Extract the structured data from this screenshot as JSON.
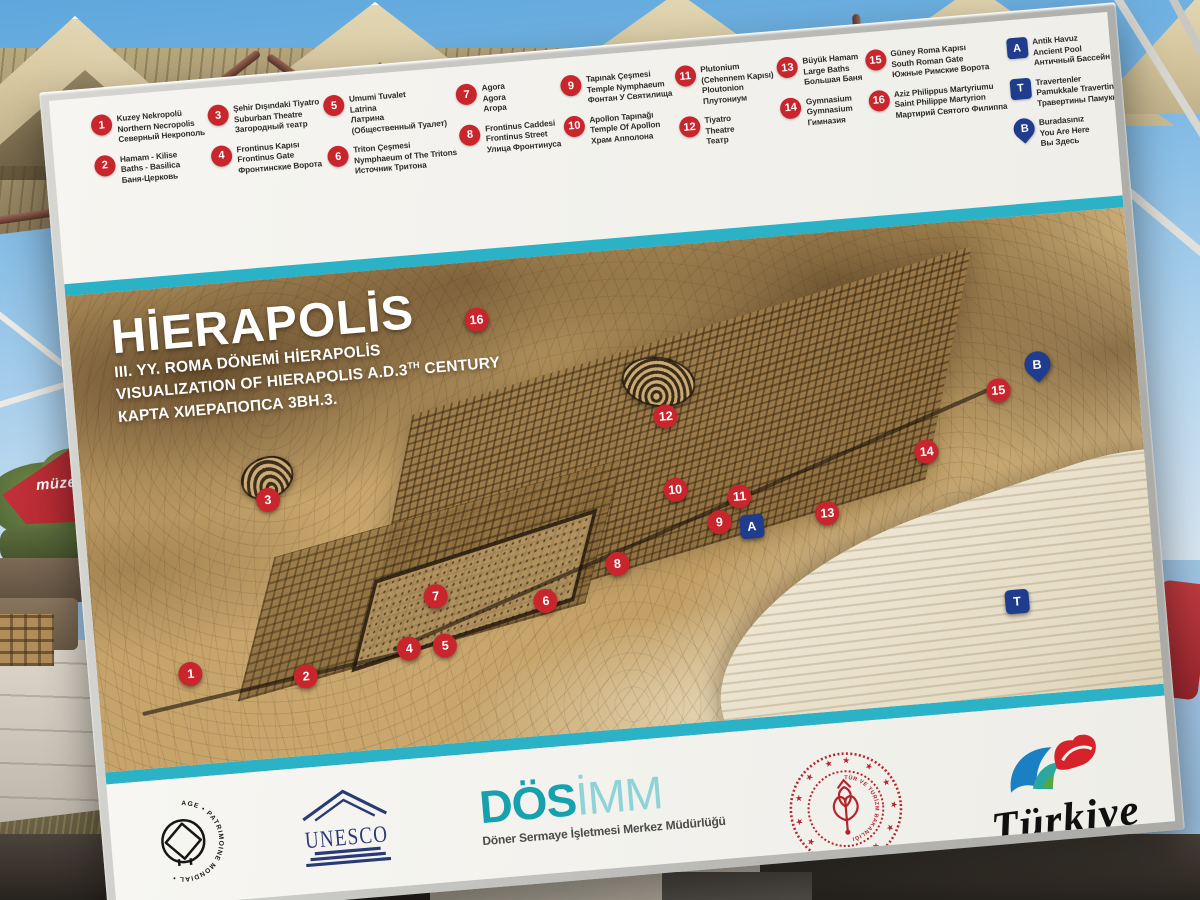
{
  "board": {
    "title": "HİERAPOLİS",
    "subtitle_tr": "III. YY. ROMA DÖNEMİ HİERAPOLİS",
    "subtitle_en_pre": "VISUALIZATION OF HIERAPOLIS A.D.3",
    "subtitle_en_sup": "TH",
    "subtitle_en_post": " CENTURY",
    "subtitle_ru": "КАРТА ХИЕРАПОПСА 3ВН.3.",
    "colors": {
      "marker_red": "#c8252c",
      "marker_blue": "#1f3d8c",
      "stripe_teal": "#2bb2c6",
      "unesco_navy": "#2a3a74",
      "ministry_red": "#b5232d",
      "dosimm_teal": "#17a0ae",
      "dosimm_light_teal": "#8fd2d8",
      "legend_text": "#2e2d2b"
    },
    "legend": {
      "columns": [
        {
          "items": [
            {
              "id": "1",
              "shape": "circle",
              "lines": [
                "Kuzey Nekropolü",
                "Northern Necropolis",
                "Северный Некрополь"
              ]
            },
            {
              "id": "2",
              "shape": "circle",
              "lines": [
                "Hamam - Kilise",
                "Baths - Basilica",
                "Баня-Церковь"
              ]
            }
          ]
        },
        {
          "items": [
            {
              "id": "3",
              "shape": "circle",
              "lines": [
                "Şehir Dışındaki Tiyatro",
                "Suburban Theatre",
                "Загородный театр"
              ]
            },
            {
              "id": "4",
              "shape": "circle",
              "lines": [
                "Frontinus Kapısı",
                "Frontinus Gate",
                "Фронтинские Ворота"
              ]
            }
          ]
        },
        {
          "items": [
            {
              "id": "5",
              "shape": "circle",
              "lines": [
                "Umumi Tuvalet",
                "Latrina",
                "Латрина",
                "(Общественный Туалет)"
              ]
            },
            {
              "id": "6",
              "shape": "circle",
              "lines": [
                "Triton Çeşmesi",
                "Nymphaeum of The Tritons",
                "Источник Тритона"
              ]
            }
          ]
        },
        {
          "items": [
            {
              "id": "7",
              "shape": "circle",
              "lines": [
                "Agora",
                "Agora",
                "Агора"
              ]
            },
            {
              "id": "8",
              "shape": "circle",
              "lines": [
                "Frontinus Caddesi",
                "Frontinus Street",
                "Улица Фронтинуса"
              ]
            }
          ]
        },
        {
          "items": [
            {
              "id": "9",
              "shape": "circle",
              "lines": [
                "Tapınak Çeşmesi",
                "Temple Nymphaeum",
                "Фонтан У Святилища"
              ]
            },
            {
              "id": "10",
              "shape": "circle",
              "lines": [
                "Apollon Tapınağı",
                "Temple Of Apollon",
                "Храм Апполона"
              ]
            }
          ]
        },
        {
          "items": [
            {
              "id": "11",
              "shape": "circle",
              "lines": [
                "Plutonium",
                "(Cehennem Kapısı)",
                "Ploutonion",
                "Плутониум"
              ]
            },
            {
              "id": "12",
              "shape": "circle",
              "lines": [
                "Tiyatro",
                "Theatre",
                "Театр"
              ]
            }
          ]
        },
        {
          "items": [
            {
              "id": "13",
              "shape": "circle",
              "lines": [
                "Büyük Hamam",
                "Large Baths",
                "Большая Баня"
              ]
            },
            {
              "id": "14",
              "shape": "circle",
              "lines": [
                "Gymnasium",
                "Gymnasium",
                "Гимназия"
              ]
            }
          ]
        },
        {
          "items": [
            {
              "id": "15",
              "shape": "circle",
              "lines": [
                "Güney Roma Kapısı",
                "South Roman Gate",
                "Южные Римские Ворота"
              ]
            },
            {
              "id": "16",
              "shape": "circle",
              "lines": [
                "Aziz Philippus Martyriumu",
                "Saint Philippe Martyrion",
                "Мартирий Святого Филиппа"
              ]
            }
          ]
        },
        {
          "items": [
            {
              "id": "A",
              "shape": "square",
              "lines": [
                "Antik Havuz",
                "Ancient Pool",
                "Античный Бассейн"
              ]
            },
            {
              "id": "T",
              "shape": "square",
              "lines": [
                "Travertenler",
                "Pamukkale Travertines",
                "Травертины Памуккале"
              ]
            },
            {
              "id": "B",
              "shape": "pin",
              "lines": [
                "Buradasınız",
                "You Are Here",
                "Вы Здесь"
              ]
            }
          ]
        }
      ]
    },
    "map_markers": [
      {
        "label": "1",
        "shape": "circle",
        "x": 8.8,
        "y": 81.0
      },
      {
        "label": "2",
        "shape": "circle",
        "x": 19.6,
        "y": 83.5
      },
      {
        "label": "3",
        "shape": "circle",
        "x": 17.4,
        "y": 46.0
      },
      {
        "label": "4",
        "shape": "circle",
        "x": 29.5,
        "y": 79.6
      },
      {
        "label": "5",
        "shape": "circle",
        "x": 32.9,
        "y": 79.4
      },
      {
        "label": "6",
        "shape": "circle",
        "x": 42.7,
        "y": 72.0
      },
      {
        "label": "7",
        "shape": "circle",
        "x": 32.4,
        "y": 69.0
      },
      {
        "label": "8",
        "shape": "circle",
        "x": 49.7,
        "y": 65.4
      },
      {
        "label": "9",
        "shape": "circle",
        "x": 59.6,
        "y": 58.5
      },
      {
        "label": "10",
        "shape": "circle",
        "x": 55.7,
        "y": 51.0
      },
      {
        "label": "11",
        "shape": "circle",
        "x": 61.7,
        "y": 53.5
      },
      {
        "label": "12",
        "shape": "circle",
        "x": 55.4,
        "y": 35.6
      },
      {
        "label": "13",
        "shape": "circle",
        "x": 69.8,
        "y": 58.5
      },
      {
        "label": "14",
        "shape": "circle",
        "x": 79.6,
        "y": 47.4
      },
      {
        "label": "15",
        "shape": "circle",
        "x": 86.8,
        "y": 36.0
      },
      {
        "label": "16",
        "shape": "circle",
        "x": 38.4,
        "y": 12.2
      },
      {
        "label": "A",
        "shape": "square",
        "x": 62.6,
        "y": 60.0
      },
      {
        "label": "T",
        "shape": "square",
        "x": 86.9,
        "y": 80.4
      },
      {
        "label": "B",
        "shape": "pin",
        "x": 90.7,
        "y": 32.4
      }
    ],
    "footer": {
      "world_heritage_ring": "DÜNYA MİRASI • WORLD HERITAGE • PATRIMOINE MONDIAL •",
      "unesco_letters": "UNESCO",
      "dosimm_bold": "DÖS",
      "dosimm_light": "İMM",
      "dosimm_tagline": "Döner Sermaye İşletmesi Merkez Müdürlüğü",
      "ministry_ring": "TÜRKİYE CUMHURİYETİ KÜLTÜR VE TURİZM BAKANLIĞI",
      "ministry_stars": "★ ★ ★ ★ ★ ★ ★ ★ ★ ★ ★ ★ ★ ★ ★ ★",
      "turkiye_script": "Türkiye"
    }
  },
  "background": {
    "umbrella_text": "müzekart"
  }
}
